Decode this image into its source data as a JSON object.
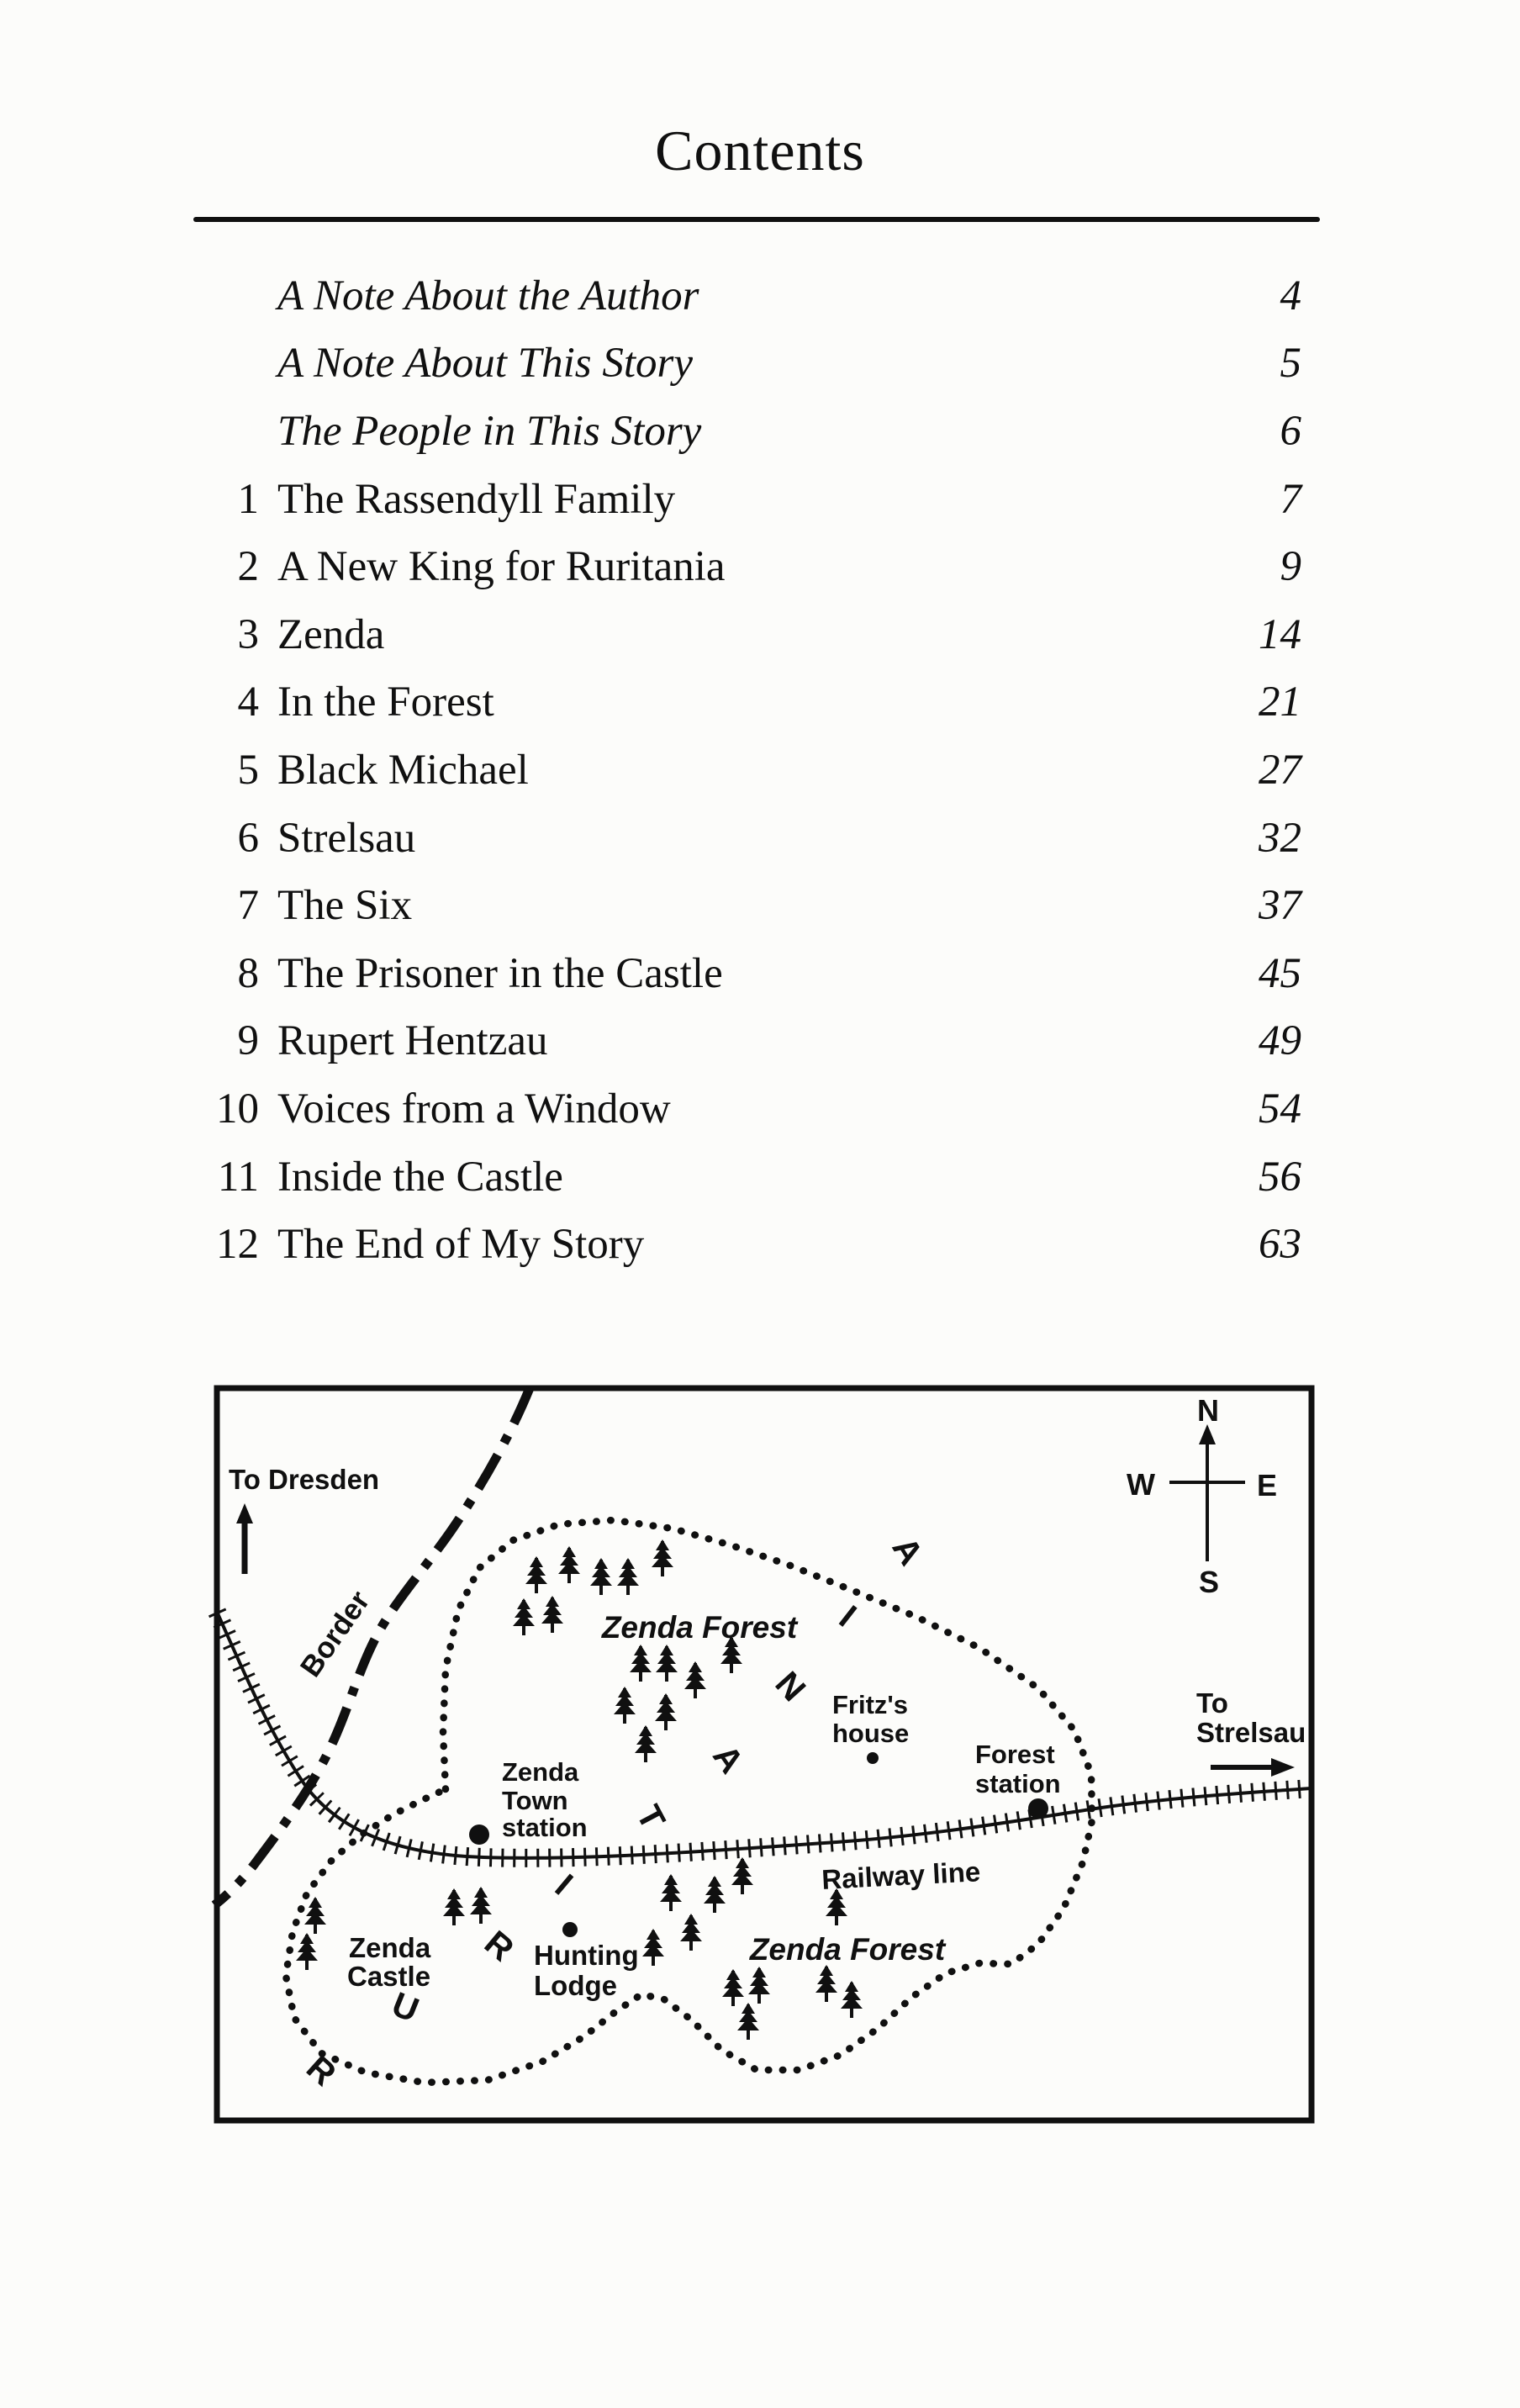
{
  "page": {
    "title": "Contents"
  },
  "toc": {
    "entries": [
      {
        "num": "",
        "title": "A Note About the Author",
        "page": "4",
        "italic": true
      },
      {
        "num": "",
        "title": "A Note About This Story",
        "page": "5",
        "italic": true
      },
      {
        "num": "",
        "title": "The People in This Story",
        "page": "6",
        "italic": true
      },
      {
        "num": "1",
        "title": "The Rassendyll Family",
        "page": "7",
        "italic": false
      },
      {
        "num": "2",
        "title": "A New King for Ruritania",
        "page": "9",
        "italic": false
      },
      {
        "num": "3",
        "title": "Zenda",
        "page": "14",
        "italic": false
      },
      {
        "num": "4",
        "title": "In the Forest",
        "page": "21",
        "italic": false
      },
      {
        "num": "5",
        "title": "Black Michael",
        "page": "27",
        "italic": false
      },
      {
        "num": "6",
        "title": "Strelsau",
        "page": "32",
        "italic": false
      },
      {
        "num": "7",
        "title": "The Six",
        "page": "37",
        "italic": false
      },
      {
        "num": "8",
        "title": "The Prisoner in the Castle",
        "page": "45",
        "italic": false
      },
      {
        "num": "9",
        "title": "Rupert Hentzau",
        "page": "49",
        "italic": false
      },
      {
        "num": "10",
        "title": "Voices from a Window",
        "page": "54",
        "italic": false
      },
      {
        "num": "11",
        "title": "Inside the Castle",
        "page": "56",
        "italic": false
      },
      {
        "num": "12",
        "title": "The End of My Story",
        "page": "63",
        "italic": false
      }
    ]
  },
  "map": {
    "labels": {
      "to_dresden": "To Dresden",
      "border": "Border",
      "zenda_forest_north": "Zenda Forest",
      "zenda_forest_south": "Zenda Forest",
      "fritz_house_l1": "Fritz's",
      "fritz_house_l2": "house",
      "forest_station_l1": "Forest",
      "forest_station_l2": "station",
      "town_station_l1": "Zenda",
      "town_station_l2": "Town",
      "town_station_l3": "station",
      "to_strelsau_l1": "To",
      "to_strelsau_l2": "Strelsau",
      "railway_line": "Railway line",
      "zenda_castle_l1": "Zenda",
      "zenda_castle_l2": "Castle",
      "hunting_lodge_l1": "Hunting",
      "hunting_lodge_l2": "Lodge",
      "country": "RURITANIA"
    },
    "compass": {
      "north": "N",
      "south": "S",
      "east": "E",
      "west": "W"
    },
    "ink_color": "#101010",
    "paper_color": "#fcfcfa"
  }
}
